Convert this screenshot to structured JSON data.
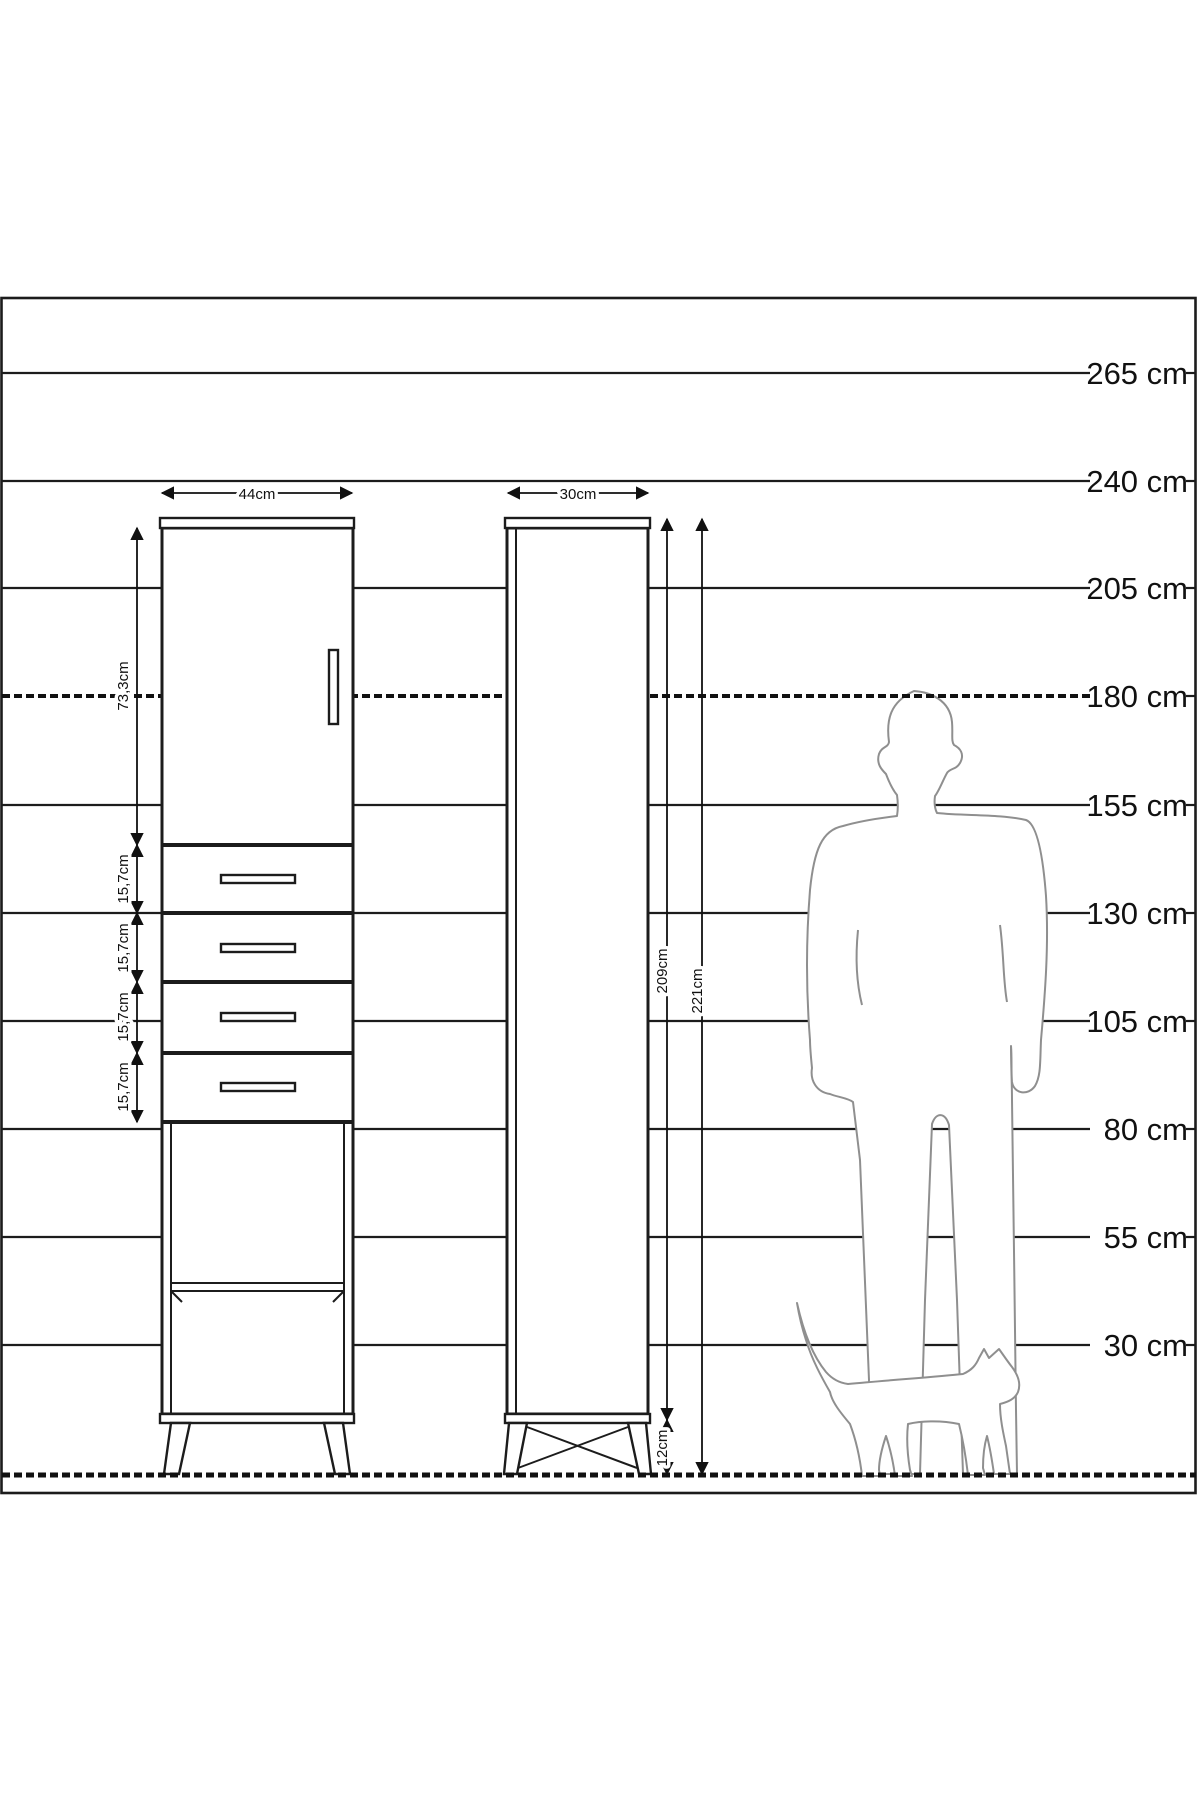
{
  "ruler": {
    "unit": "cm",
    "labels": [
      "265 cm",
      "240 cm",
      "205 cm",
      "180 cm",
      "155 cm",
      "130 cm",
      "105 cm",
      "80 cm",
      "55 cm",
      "30 cm"
    ],
    "dashed_level": "180 cm"
  },
  "front_view": {
    "width_label": "44cm",
    "door_height_label": "73,3cm",
    "drawer_height_labels": [
      "15,7cm",
      "15,7cm",
      "15,7cm",
      "15,7cm"
    ]
  },
  "side_view": {
    "width_label": "30cm",
    "body_height_label": "209cm",
    "total_height_label": "221cm",
    "leg_height_label": "12cm"
  },
  "colors": {
    "line": "#1c1c1c",
    "silhouette": "#8f8f8f",
    "background": "#ffffff"
  }
}
